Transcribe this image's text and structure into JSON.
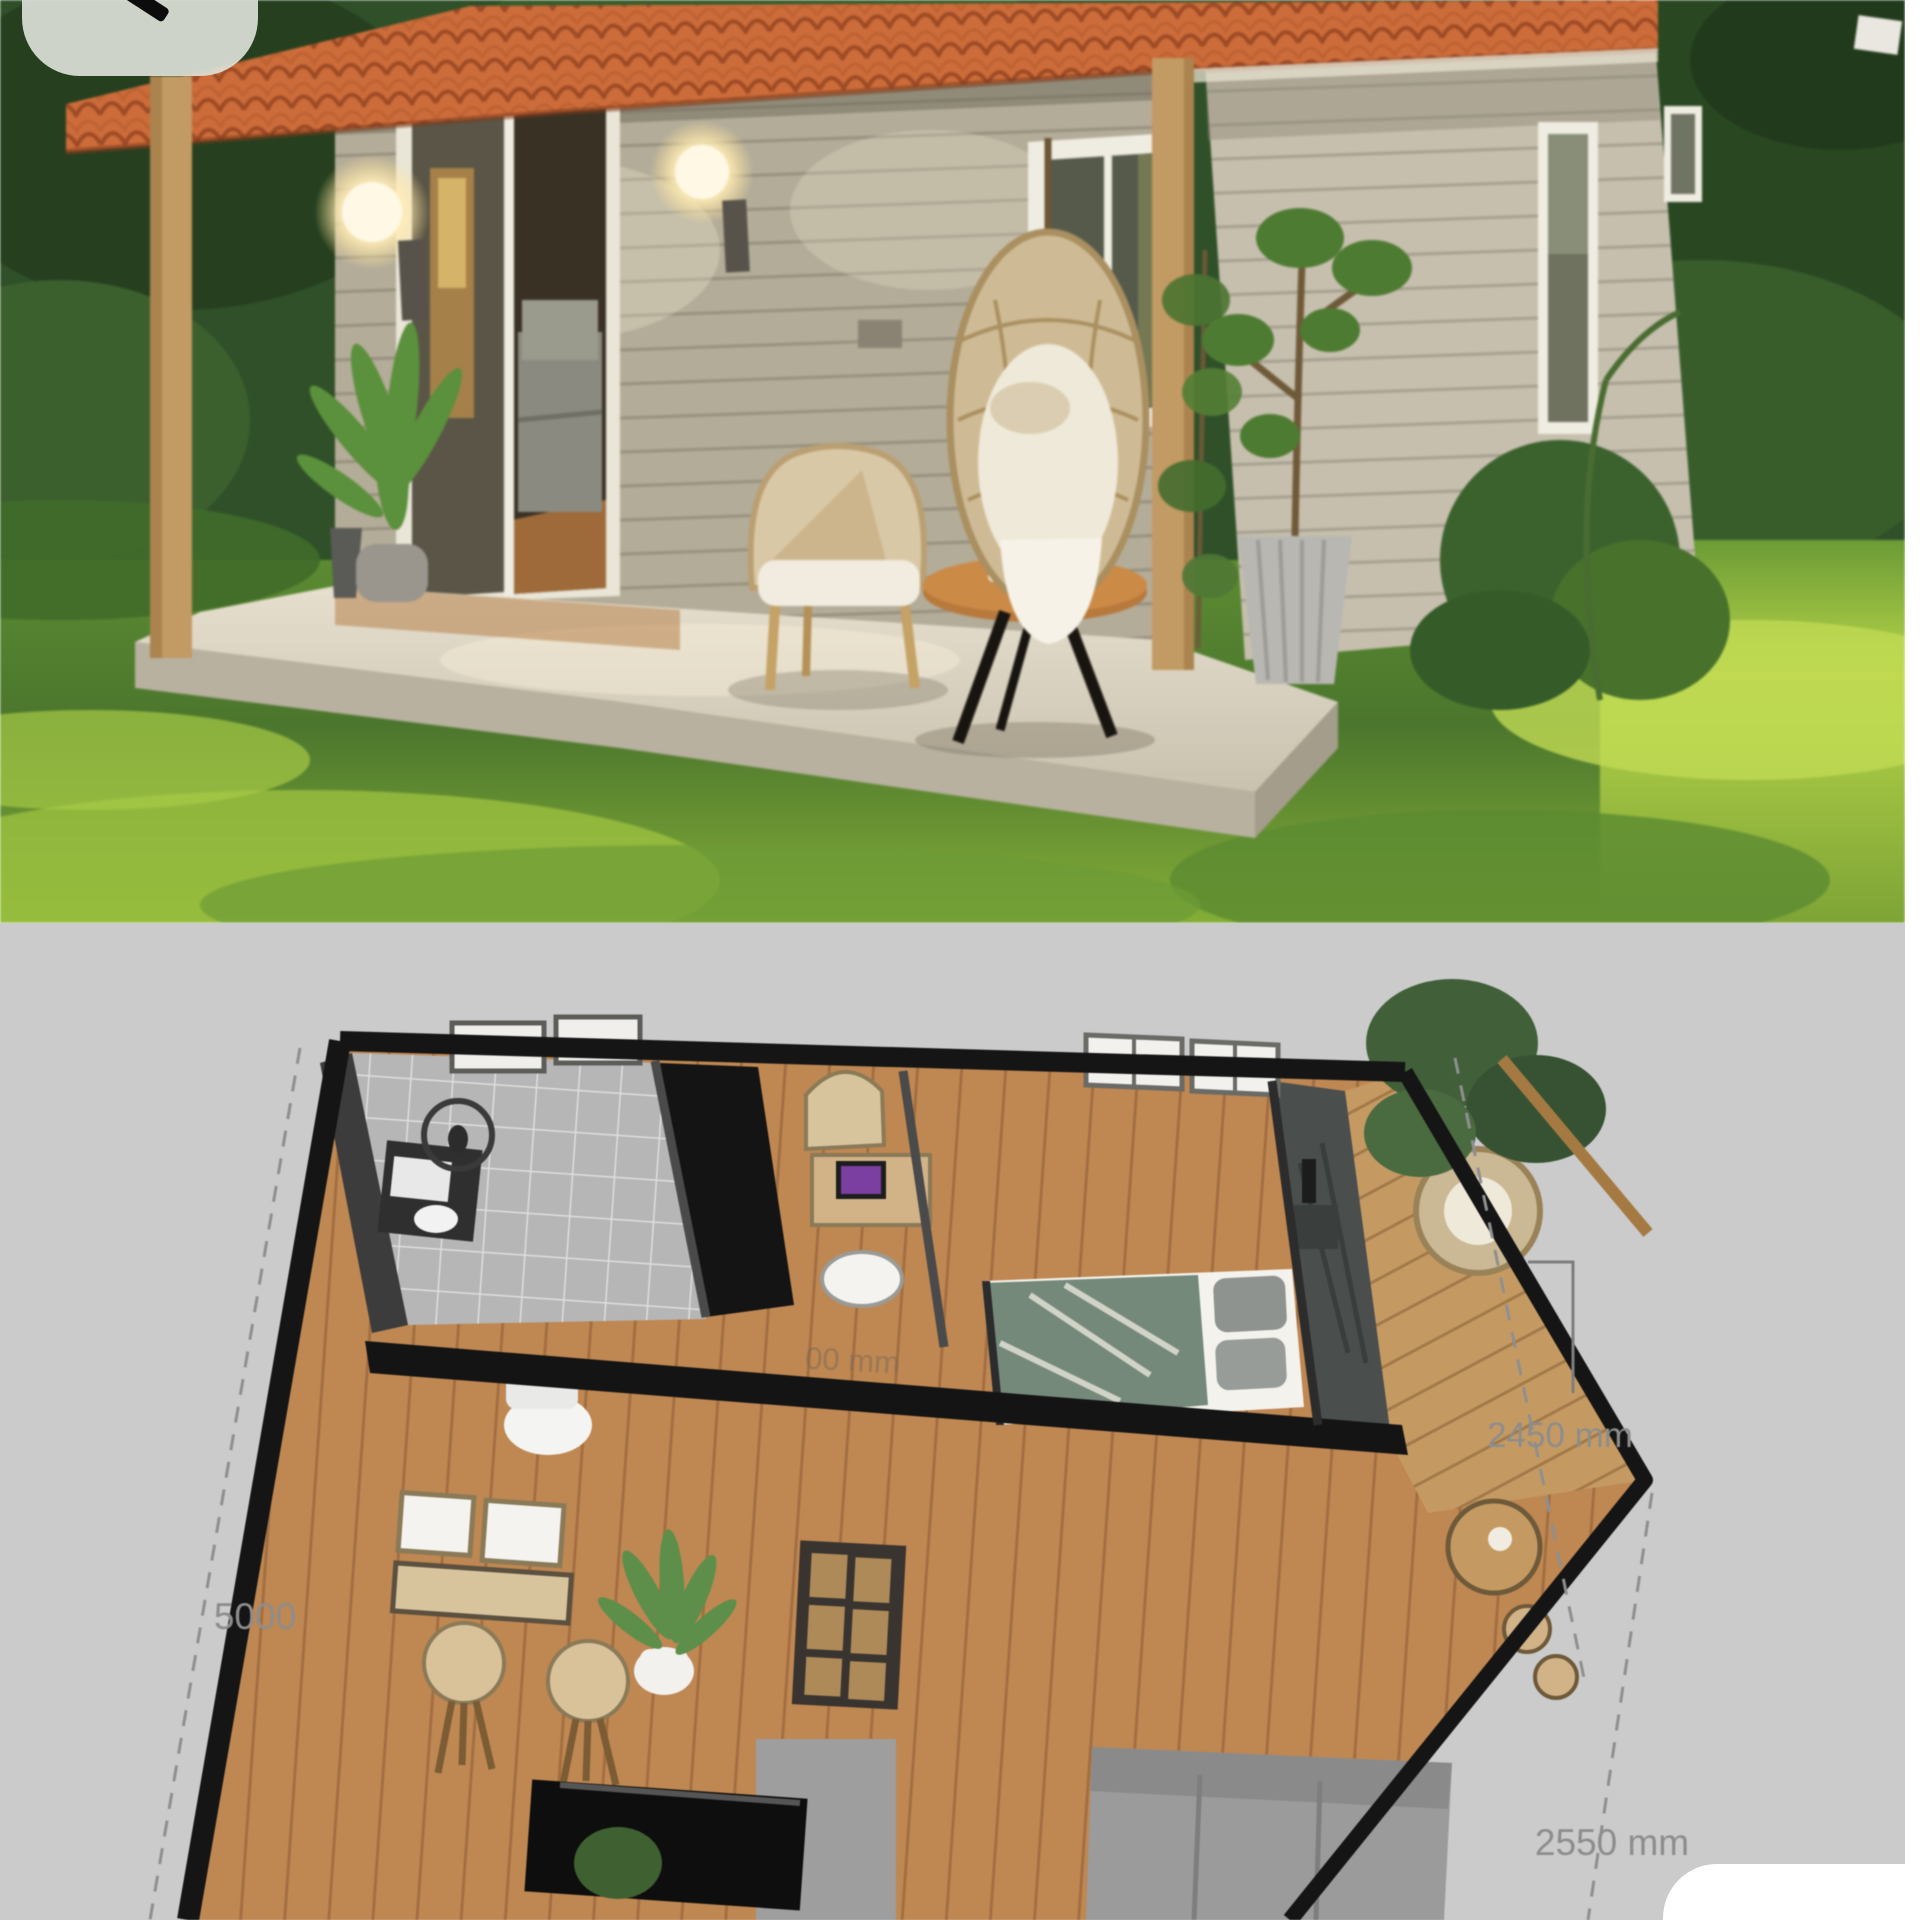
{
  "ui": {
    "back_pill": {
      "icon": "back-arrow-icon"
    },
    "bottom_corner_card": {}
  },
  "floor_plan": {
    "dim_left": "5000",
    "dim_right": "2450 mm",
    "dim_bottom": "2550 mm",
    "watermark": "00 mm"
  },
  "colors": {
    "plan_background": "#cbcbcb",
    "right_strip": "#ffffff",
    "roof_terracotta": "#c86d3d",
    "roof_ridge": "#9a4b28",
    "wood_post": "#c09a66",
    "porch_wall_siding": "#b3ac99",
    "gable_wall_siding": "#c6bfae",
    "platform_concrete": "#d8d2c2",
    "grass_sunlit": "#a4c445",
    "grass_shaded": "#4c7530",
    "trees_dark": "#2f4d27",
    "egg_chair_rattan": "#cdbb97",
    "table_wood": "#b5793f",
    "plan_wall_black": "#151515",
    "plan_floor_wood": "#bf8752",
    "plan_deck_wood": "#c59a62",
    "plan_tile_gray": "#b6b6b6",
    "bed_blanket_teal": "#75897b",
    "sofa_gray": "#9b9b9b",
    "laptop_screen_purple": "#7a3fa0",
    "dimension_text": "#8d8d8d"
  }
}
